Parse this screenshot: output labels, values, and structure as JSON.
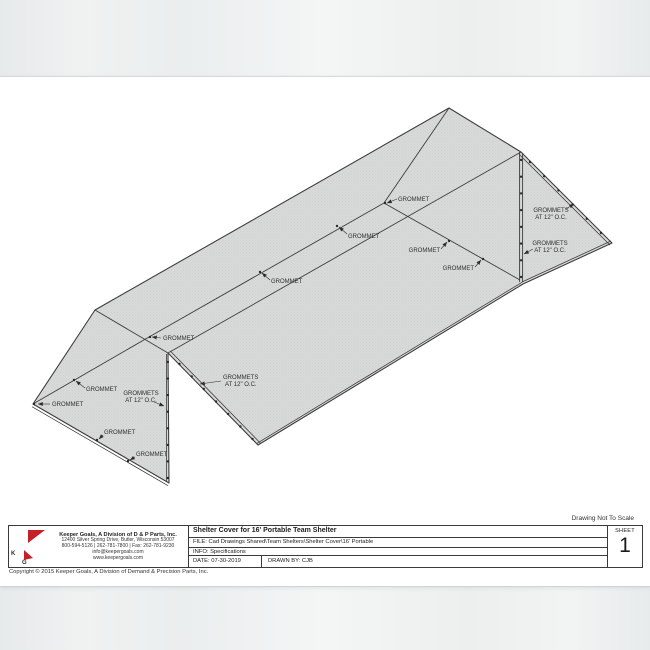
{
  "page": {
    "note": "Drawing Not To Scale",
    "copyright": "Copyright © 2015 Keeper Goals, A Division of Demand & Precision Parts, Inc."
  },
  "logo": {
    "k": "K",
    "g": "G",
    "red": "#c42127",
    "black": "#111111"
  },
  "title_block": {
    "company_name": "Keeper Goals, A Division of D & P Parts, Inc.",
    "address": "12400 Silver Spring Drive, Butler, Wisconsin  53007",
    "phone": "800-594-5126 | 262-781-7800 | Fax: 262-781-9230",
    "email": "info@keepergoals.com",
    "web": "www.keepergoals.com",
    "title": "Shelter Cover for 16' Portable Team Shelter",
    "file": "FILE: Cad Drawings Shared\\Team Shelters\\Shelter Cover\\16' Portable",
    "info": "INFO: Specifications",
    "date": "DATE: 07-30-2019",
    "drawn_by": "DRAWN BY: CJB",
    "sheet_label": "SHEET",
    "sheet_number": "1"
  },
  "drawing": {
    "subject": "Shelter cover for 16' portable team shelter, isometric view",
    "fabric_fill": "#d8dad9",
    "line_color": "#3d3d3d",
    "annotations": [
      {
        "text": "GROMMET"
      },
      {
        "text": "GROMMET"
      },
      {
        "text": "GROMMET"
      },
      {
        "text": "GROMMET"
      },
      {
        "text": "GROMMET"
      },
      {
        "text": "GROMMET"
      },
      {
        "text": "GROMMET"
      },
      {
        "text": "GROMMET"
      },
      {
        "text": "GROMMET"
      },
      {
        "text": "GROMMET"
      },
      {
        "l1": "GROMMETS",
        "l2": "AT 12\" O.C."
      },
      {
        "l1": "GROMMETS",
        "l2": "AT 12\" O.C."
      },
      {
        "l1": "GROMMETS",
        "l2": "AT 12\" O.C."
      },
      {
        "l1": "GROMMETS",
        "l2": "AT 12\" O.C."
      }
    ]
  }
}
